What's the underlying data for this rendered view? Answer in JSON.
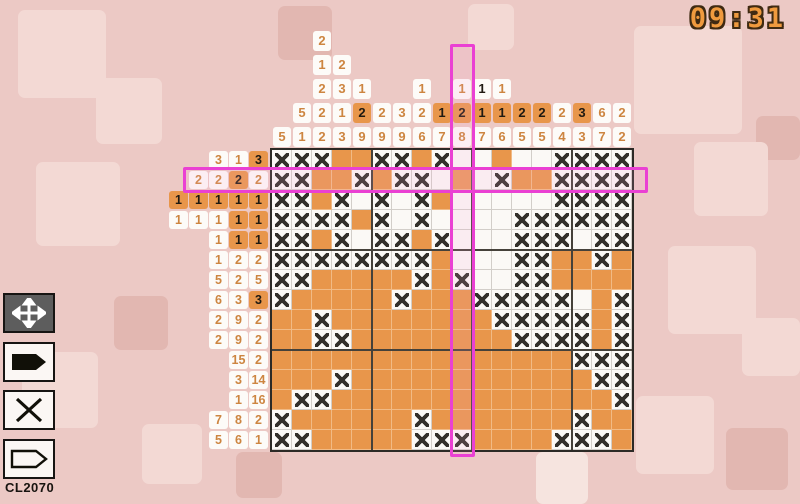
{
  "timer": "09:31",
  "level_code": "CL2070",
  "toolbar": {
    "buttons": [
      {
        "id": "move",
        "icon": "move-icon"
      },
      {
        "id": "fill",
        "icon": "marker-filled-icon"
      },
      {
        "id": "cross",
        "icon": "cross-icon"
      },
      {
        "id": "empty",
        "icon": "marker-outline-icon"
      }
    ]
  },
  "board": {
    "cols": 18,
    "rows": 15,
    "cell_px": 20,
    "highlight": {
      "col": 10,
      "row": 2
    },
    "col_clues": [
      [
        {
          "v": 5
        }
      ],
      [
        {
          "v": 5
        },
        {
          "v": 1
        }
      ],
      [
        {
          "v": 2
        },
        {
          "v": 1
        },
        {
          "v": 2
        },
        {
          "v": 2
        },
        {
          "v": 2
        }
      ],
      [
        {
          "v": 2
        },
        {
          "v": 3
        },
        {
          "v": 1
        },
        {
          "v": 3
        }
      ],
      [
        {
          "v": 1
        },
        {
          "v": 2,
          "hl": true
        },
        {
          "v": 9
        }
      ],
      [
        {
          "v": 2
        },
        {
          "v": 9
        }
      ],
      [
        {
          "v": 3
        },
        {
          "v": 9
        }
      ],
      [
        {
          "v": 1
        },
        {
          "v": 2
        },
        {
          "v": 6
        }
      ],
      [
        {
          "v": 1,
          "hl": true
        },
        {
          "v": 7
        }
      ],
      [
        {
          "v": 1
        },
        {
          "v": 2,
          "hl": true
        },
        {
          "v": 8
        }
      ],
      [
        {
          "v": 1,
          "b": true
        },
        {
          "v": 1,
          "hl": true
        },
        {
          "v": 7
        }
      ],
      [
        {
          "v": 1
        },
        {
          "v": 1,
          "hl": true
        },
        {
          "v": 6
        }
      ],
      [
        {
          "v": 2,
          "hl": true
        },
        {
          "v": 5
        }
      ],
      [
        {
          "v": 2,
          "hl": true
        },
        {
          "v": 5
        }
      ],
      [
        {
          "v": 2
        },
        {
          "v": 4
        }
      ],
      [
        {
          "v": 3,
          "hl": true
        },
        {
          "v": 3
        }
      ],
      [
        {
          "v": 6
        },
        {
          "v": 7
        }
      ],
      [
        {
          "v": 2
        },
        {
          "v": 2
        }
      ]
    ],
    "row_clues": [
      [
        {
          "v": 3
        },
        {
          "v": 1
        },
        {
          "v": 3,
          "hl": true
        }
      ],
      [
        {
          "v": 2
        },
        {
          "v": 2
        },
        {
          "v": 2,
          "hl": true
        },
        {
          "v": 2
        }
      ],
      [
        {
          "v": 1,
          "hl": true
        },
        {
          "v": 1,
          "hl": true
        },
        {
          "v": 1,
          "hl": true
        },
        {
          "v": 1,
          "hl": true
        },
        {
          "v": 1,
          "hl": true
        }
      ],
      [
        {
          "v": 1
        },
        {
          "v": 1
        },
        {
          "v": 1
        },
        {
          "v": 1,
          "hl": true
        },
        {
          "v": 1,
          "hl": true
        }
      ],
      [
        {
          "v": 1
        },
        {
          "v": 1,
          "hl": true
        },
        {
          "v": 1,
          "hl": true
        }
      ],
      [
        {
          "v": 1
        },
        {
          "v": 2
        },
        {
          "v": 2
        }
      ],
      [
        {
          "v": 5
        },
        {
          "v": 2
        },
        {
          "v": 5
        }
      ],
      [
        {
          "v": 6
        },
        {
          "v": 3
        },
        {
          "v": 3,
          "hl": true
        }
      ],
      [
        {
          "v": 2
        },
        {
          "v": 9
        },
        {
          "v": 2
        }
      ],
      [
        {
          "v": 2
        },
        {
          "v": 9
        },
        {
          "v": 2
        }
      ],
      [
        {
          "v": 15
        },
        {
          "v": 2
        }
      ],
      [
        {
          "v": 3
        },
        {
          "v": 14
        }
      ],
      [
        {
          "v": 1
        },
        {
          "v": 16
        }
      ],
      [
        {
          "v": 7
        },
        {
          "v": 8
        },
        {
          "v": 2
        }
      ],
      [
        {
          "v": 5
        },
        {
          "v": 6
        },
        {
          "v": 1
        }
      ]
    ],
    "grid": [
      "XXXOOXXOX..O..XXXX",
      "XXOOXOXX.O.XOOXXXX",
      "XXOX.X.XO.....XXXX",
      "XXXXOX.X....XXXXXX",
      "XXOX.XXOX...XXX.XX",
      "XXXXXXXXO...XXOOXO",
      "XXOOOOOXOX..XXOOOO",
      "XOOOOOXOOOXXXXX.OX",
      "OOXOOOOOOOOXXXXXOX",
      "OOXXOOOOOOOOXXXXOX",
      "OOOOOOOOOOOOOOOXXX",
      "OOOXOOOOOOOOOOOOXX",
      "OXXOOOOOOOOOOOOOOX",
      "XOOOOOOXOOOOOOOXOO",
      "XXOOOOOXXXOOOOXXXO"
    ]
  },
  "colors": {
    "fill_orange": "#e8964b",
    "highlight_magenta": "#ea40d3",
    "background_pink": "#ecc9c5",
    "timer_orange": "#ef9a3e"
  }
}
